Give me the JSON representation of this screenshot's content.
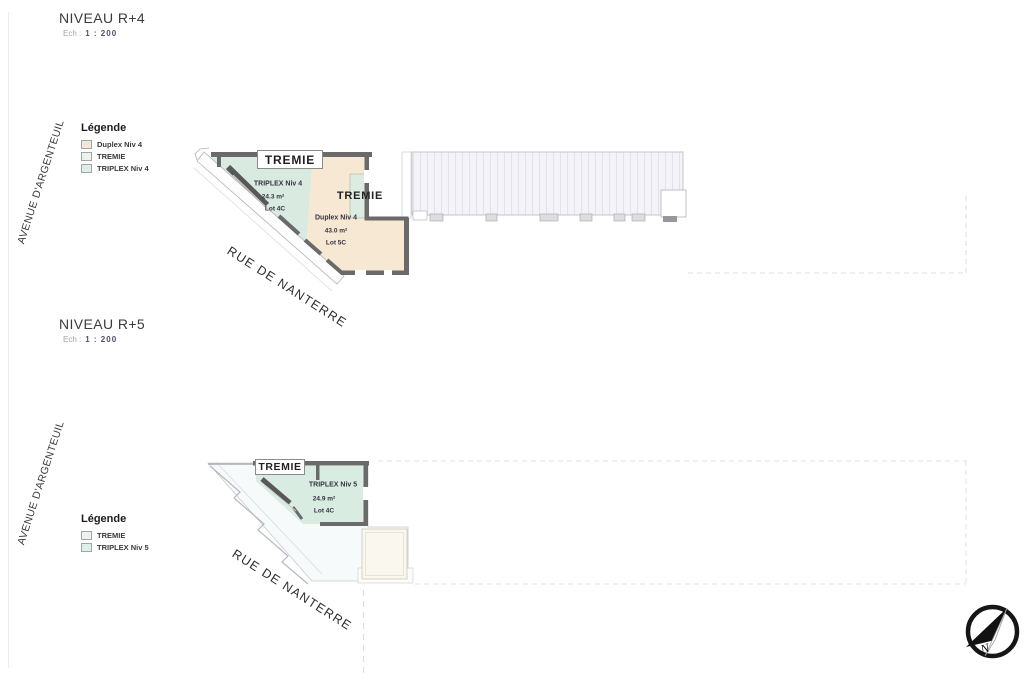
{
  "sections": [
    {
      "title": "NIVEAU R+4",
      "scale": {
        "label": "Ech :",
        "value": "1 : 200"
      },
      "street_left": "AVENUE D'ARGENTEUIL",
      "street_diagonal": "RUE DE NANTERRE",
      "legend": {
        "title": "Légende",
        "items": [
          {
            "label": "Duplex Niv 4",
            "color": "#f3e7da"
          },
          {
            "label": "TREMIE",
            "color": "#eef2ec"
          },
          {
            "label": "TRIPLEX Niv 4",
            "color": "#dfeee6"
          }
        ]
      },
      "plan": {
        "tremie_box": "TREMIE",
        "tremie_inner": "TREMIE",
        "units": [
          {
            "name": "TRIPLEX Niv 4",
            "area": "24.3 m²",
            "lot": "Lot 4C"
          },
          {
            "name": "Duplex Niv 4",
            "area": "43.0 m²",
            "lot": "Lot 5C"
          }
        ]
      }
    },
    {
      "title": "NIVEAU R+5",
      "scale": {
        "label": "Ech :",
        "value": "1 : 200"
      },
      "street_left": "AVENUE D'ARGENTEUIL",
      "street_diagonal": "RUE DE NANTERRE",
      "legend": {
        "title": "Légende",
        "items": [
          {
            "label": "TREMIE",
            "color": "#eef2ec"
          },
          {
            "label": "TRIPLEX Niv 5",
            "color": "#dcefe8"
          }
        ]
      },
      "plan": {
        "tremie_box": "TREMIE",
        "units": [
          {
            "name": "TRIPLEX Niv 5",
            "area": "24.9 m²",
            "lot": "Lot 4C"
          }
        ]
      }
    }
  ],
  "compass": {
    "label": "N"
  },
  "colors": {
    "duplex_fill": "#f6e8d3",
    "triplex_fill": "#d9ebe1",
    "tremie_fill": "#e8f1ea",
    "terrace_fill": "#f7fafb",
    "annex_fill": "#faf8ee",
    "roof_fill": "#f4f4f8",
    "wall": "#6a6a6a",
    "dashed_line": "#dcdcdc"
  }
}
